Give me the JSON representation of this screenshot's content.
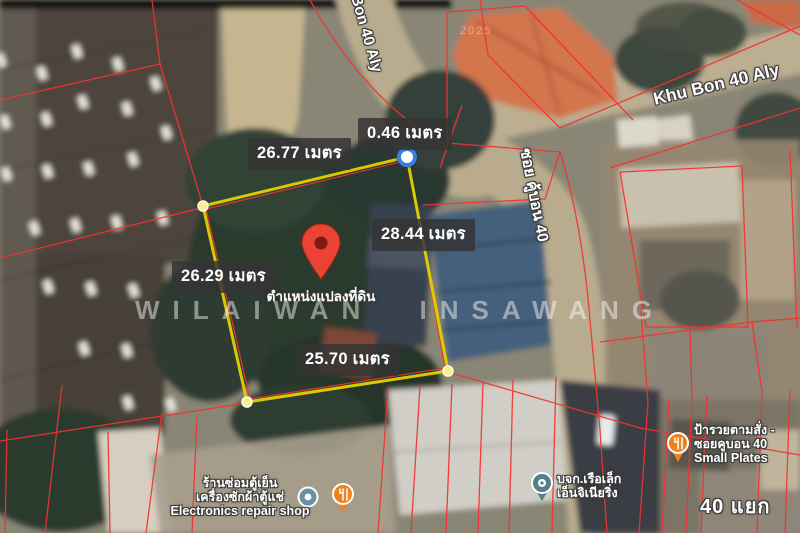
{
  "measurements": {
    "top": "26.77 เมตร",
    "corner": "0.46 เมตร",
    "right": "28.44 เมตร",
    "left": "26.29 เมตร",
    "bottom": "25.70 เมตร"
  },
  "plot": {
    "marker_label": "ตำแหน่งแปลงที่ดิน"
  },
  "streets": {
    "top_alley": "Khu Bon 40 Aly",
    "right_alley": "Khu Bon 40 Aly",
    "soi": "ซอย คู้บอน 40",
    "junction": "40 แยก"
  },
  "pois": [
    {
      "id": "electronics-repair-shop",
      "lines": [
        "ร้านซ่อมตู้เย็น",
        "เครื่องซักผ้าตู้แช่",
        "Electronics repair shop"
      ]
    },
    {
      "id": "ruea-lek-engineering",
      "lines": [
        "บจก.เรือเล็ก",
        "เอ็นจิเนียริ่ง"
      ]
    },
    {
      "id": "pa-ruay-small-plates",
      "lines": [
        "ป้ารวยตามสั่ง -",
        "ซอยคูบอน 40",
        "Small Plates"
      ]
    }
  ],
  "watermark": "WILAIWAN INSAWANG",
  "imagery_year": "2025",
  "colors": {
    "plot_outline": "#dccf00",
    "parcel_line": "#f2332e",
    "measure_bg": "rgba(52,52,52,0.84)",
    "pin_red": "#ea4335",
    "poi_orange": "#ec8220",
    "poi_teal": "#5e8591",
    "vertex_blue": "#3a7de0"
  }
}
